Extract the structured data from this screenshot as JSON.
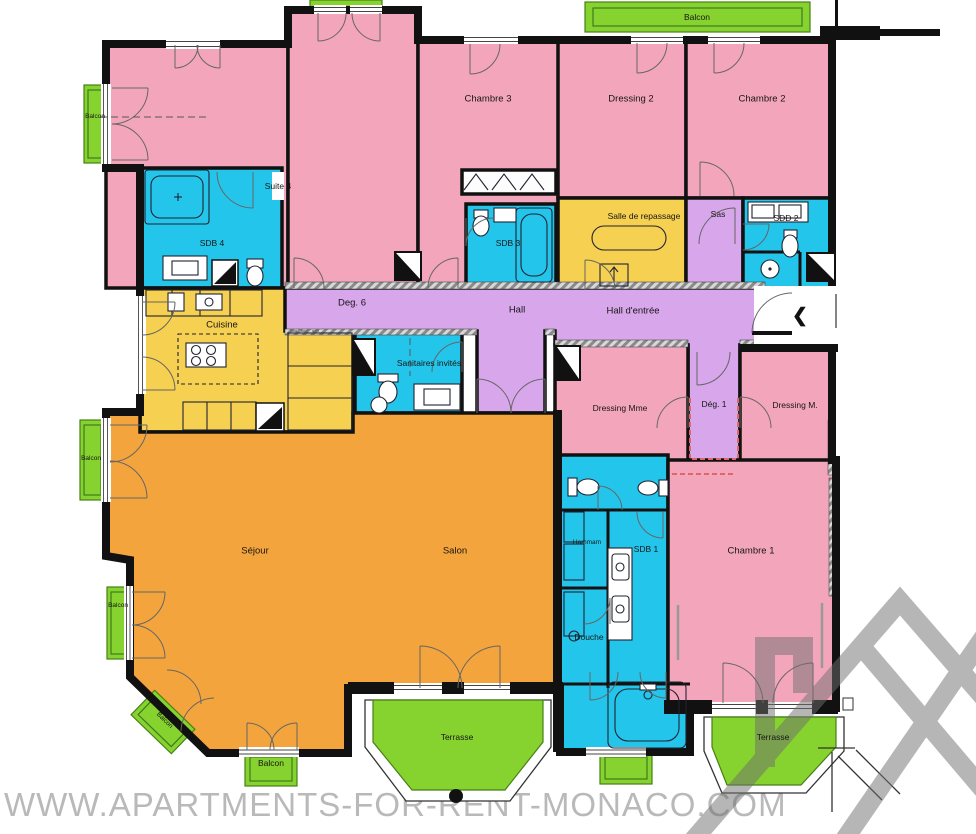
{
  "watermark": {
    "text": "WWW.APARTMENTS-FOR-RENT-MONACO.COM"
  },
  "palette": {
    "bedroom_pink": "#F3A6BB",
    "bath_cyan": "#23C6EA",
    "service_yellow": "#F6D050",
    "circulation_purple": "#D8A6EA",
    "living_orange": "#F4A43C",
    "outdoor_green": "#86D32F",
    "wall_black": "#111111",
    "watermark_gray": "#B9B9B9",
    "logo_gray": "#6F6F6F"
  },
  "rooms": {
    "suite4": {
      "label": "Suite 4"
    },
    "sdb4": {
      "label": "SDB 4"
    },
    "chambre3": {
      "label": "Chambre 3"
    },
    "sdb3": {
      "label": "SDB 3"
    },
    "dressing2": {
      "label": "Dressing 2"
    },
    "chambre2": {
      "label": "Chambre 2"
    },
    "salle_de_repassage": {
      "label": "Salle de repassage"
    },
    "sas": {
      "label": "Sas"
    },
    "sdd2": {
      "label": "SDD 2"
    },
    "deg6": {
      "label": "Deg. 6"
    },
    "hall": {
      "label": "Hall"
    },
    "hall_entree": {
      "label": "Hall d'entrée"
    },
    "cuisine": {
      "label": "Cuisine"
    },
    "sanitaires_invites": {
      "label": "Sanitaires invités"
    },
    "dressing_mme": {
      "label": "Dressing Mme"
    },
    "deg1": {
      "label": "Dég. 1"
    },
    "dressing_m": {
      "label": "Dressing M."
    },
    "sejour": {
      "label": "Séjour"
    },
    "salon": {
      "label": "Salon"
    },
    "hammam": {
      "label": "Hammam"
    },
    "sdb1": {
      "label": "SDB 1"
    },
    "douche": {
      "label": "Douche"
    },
    "chambre1": {
      "label": "Chambre 1"
    },
    "terrasse": {
      "label": "Terrasse"
    },
    "balcon": {
      "label": "Balcon"
    }
  },
  "icons": {
    "entrance_arrow": "❮"
  }
}
